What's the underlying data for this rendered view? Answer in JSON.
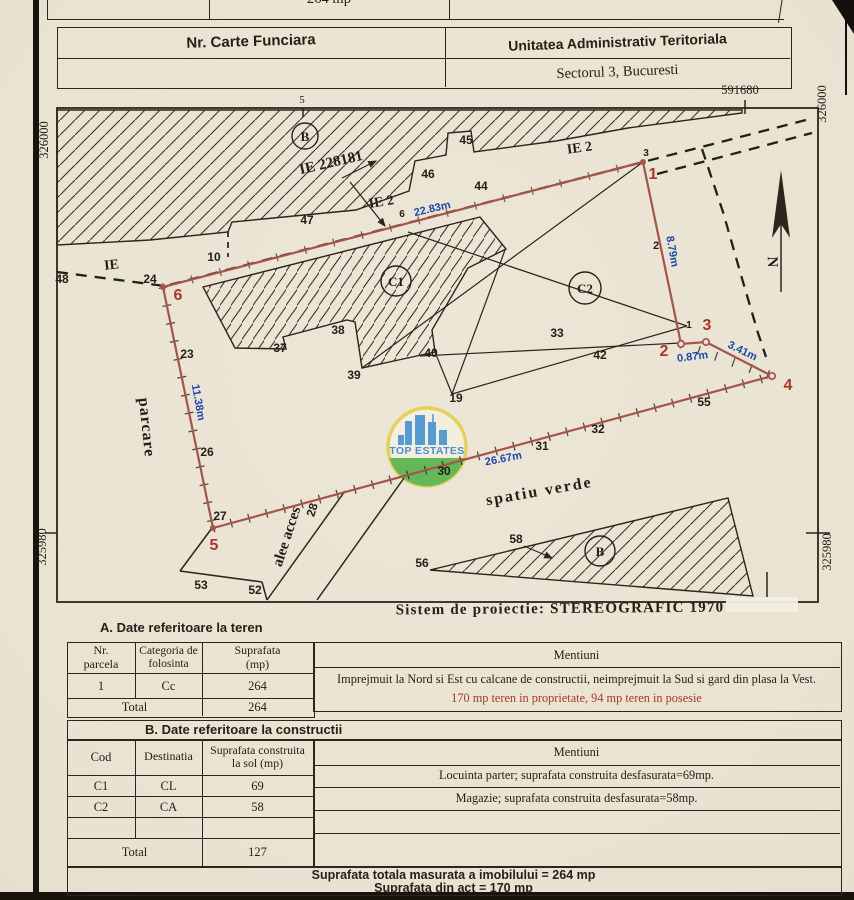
{
  "top_strip": {
    "value": "264 mp"
  },
  "header": {
    "left": "Nr. Carte Funciara",
    "right_top": "Unitatea Administrativ Teritoriala",
    "right_bottom": "Sectorul 3, Bucuresti"
  },
  "grid": {
    "top_right": "591680",
    "top_mid": "5",
    "left_top": "326000",
    "left_bottom": "325980",
    "right_top": "326000",
    "right_bottom": "325980"
  },
  "plan": {
    "black": [
      "48",
      "IE",
      "24",
      "10",
      "47",
      "46",
      "45",
      "44",
      "IE 228181",
      "IE 2",
      "6",
      "IE 2",
      "3",
      "2",
      "1",
      "33",
      "37",
      "38",
      "39",
      "40",
      "19",
      "42",
      "55",
      "32",
      "31",
      "30",
      "28",
      "26",
      "23",
      "27",
      "56",
      "58",
      "53",
      "52",
      "parcare",
      "alee acces",
      "spatiu verde"
    ],
    "circled": [
      "B",
      "C1",
      "C2",
      "B"
    ],
    "red": [
      "6",
      "1",
      "2",
      "3",
      "4",
      "5"
    ],
    "blue": [
      "22.83m",
      "8.79m",
      "0.87m",
      "3.41m",
      "26.67m",
      "11.38m"
    ],
    "north": "N",
    "watermark": "TOP ESTATES"
  },
  "projection": "Sistem de proiectie: STEREOGRAFIC 1970",
  "section_a": {
    "title": "A. Date referitoare la teren",
    "col_nr_1": "Nr.",
    "col_nr_2": "parcela",
    "col_cat_1": "Categoria de",
    "col_cat_2": "folosinta",
    "col_sup_1": "Suprafata",
    "col_sup_2": "(mp)",
    "col_men": "Mentiuni",
    "row": [
      "1",
      "Cc",
      "264"
    ],
    "total_label": "Total",
    "total_value": "264",
    "mentiuni_1": "Imprejmuit la Nord si Est cu calcane de constructii, neimprejmuit la Sud si gard din plasa la Vest.",
    "mentiuni_2": "170 mp teren in proprietate, 94 mp teren in posesie"
  },
  "section_b": {
    "title": "B. Date referitoare la constructii",
    "col_cod": "Cod",
    "col_dest": "Destinatia",
    "col_sup_1": "Suprafata construita",
    "col_sup_2": "la sol (mp)",
    "col_men": "Mentiuni",
    "rows": [
      [
        "C1",
        "CL",
        "69"
      ],
      [
        "C2",
        "CA",
        "58"
      ]
    ],
    "total_label": "Total",
    "total_value": "127",
    "mentiuni_1": "Locuinta parter; suprafata construita desfasurata=69mp.",
    "mentiuni_2": "Magazie; suprafata construita desfasurata=58mp."
  },
  "summary": {
    "line1": "Suprafata totala masurata a imobilului = 264 mp",
    "line2": "Suprafata din act = 170 mp"
  },
  "colors": {
    "ink": "#2b251b",
    "boundary_red": "#a5544a",
    "label_red": "#ad352a",
    "dim_blue": "#1d49ae",
    "paper": "#e9e2d1"
  }
}
